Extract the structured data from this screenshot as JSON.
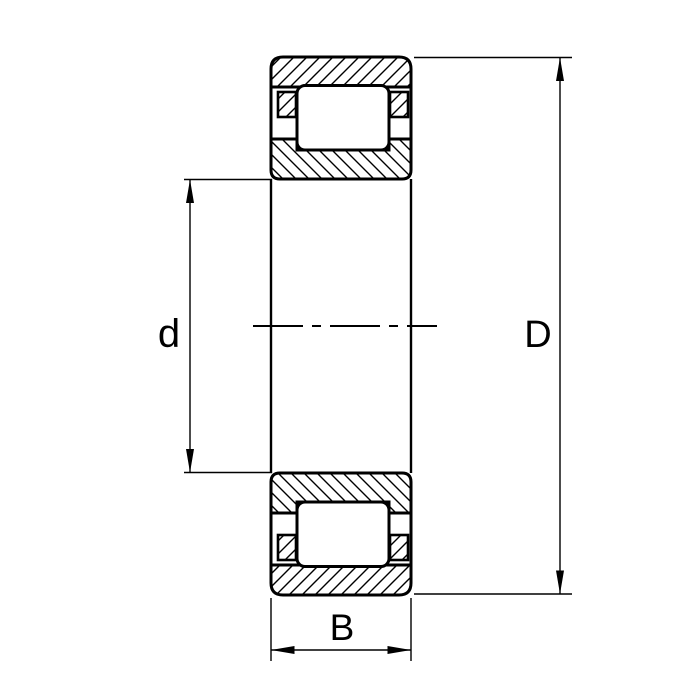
{
  "figure": "cylindrical-roller-bearing-cross-section",
  "labels": {
    "bore_diameter": "d",
    "outer_diameter": "D",
    "width": "B"
  },
  "colors": {
    "line": "#000000",
    "background": "#ffffff"
  }
}
